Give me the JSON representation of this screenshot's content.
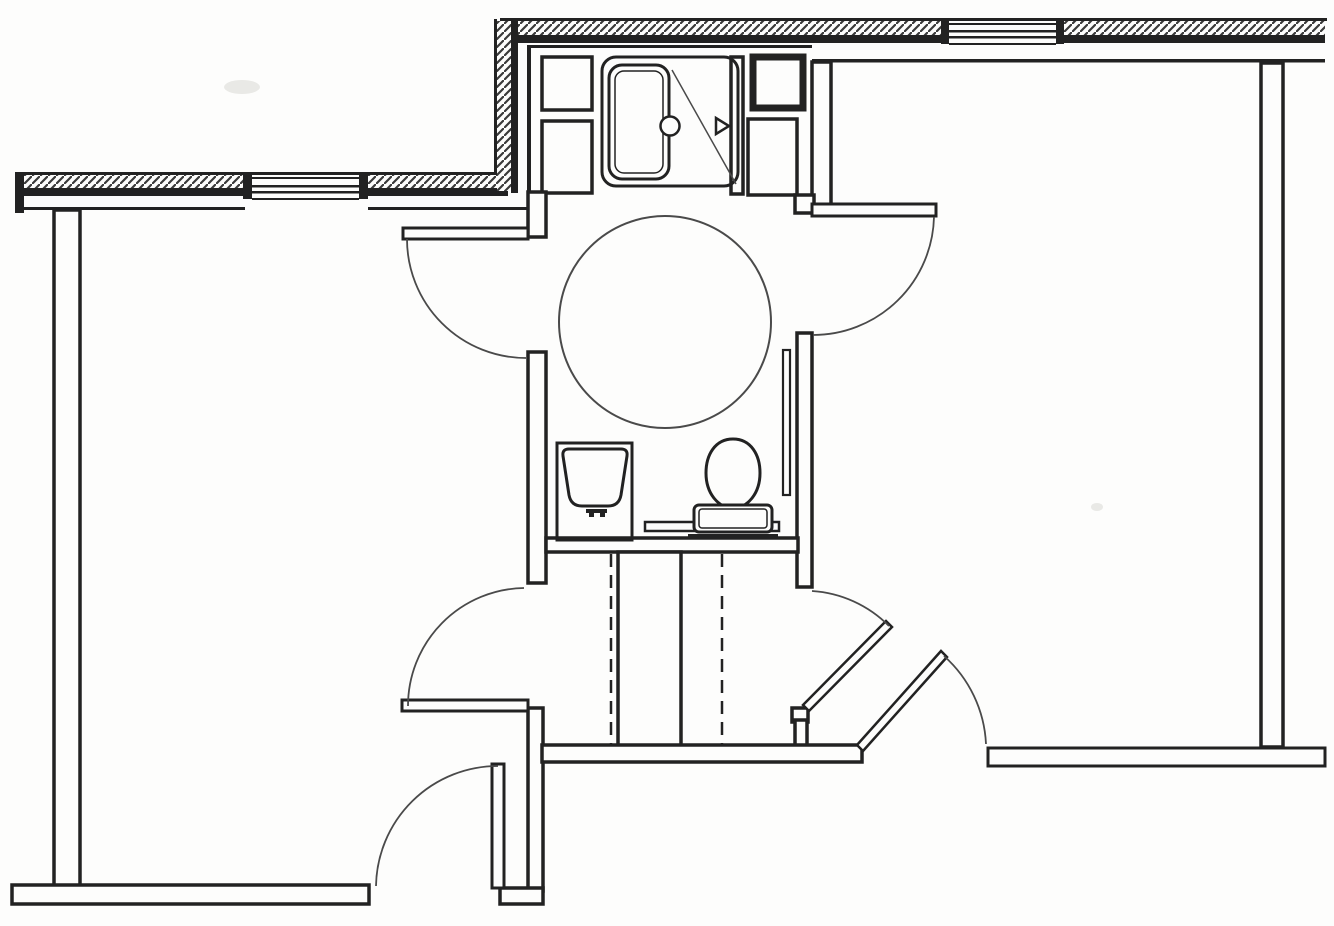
{
  "meta": {
    "description": "accessible-bathroom-floor-plan",
    "canvas": {
      "width": 1334,
      "height": 926
    }
  },
  "palette": {
    "paper": "#fdfdfc",
    "ink": "#222222",
    "light": "#4a4a4a",
    "hatch": "#3a3a3a",
    "smudge": "#e9e9e6"
  },
  "plan": {
    "elements": [
      {
        "name": "scan-smudge-1",
        "kind": "blob",
        "cx": 242,
        "cy": 87,
        "rx": 18,
        "ry": 7
      },
      {
        "name": "scan-smudge-2",
        "kind": "blob",
        "cx": 1097,
        "cy": 507,
        "rx": 6,
        "ry": 4
      },
      {
        "name": "north-wall-outer-edge",
        "kind": "fillrect",
        "x": 500,
        "y": 18,
        "w": 827,
        "h": 3
      },
      {
        "name": "north-wall-hatch-west",
        "kind": "hatchrect",
        "x": 504,
        "y": 21,
        "w": 439,
        "h": 15
      },
      {
        "name": "north-wall-inner-band-west",
        "kind": "fillrect",
        "x": 504,
        "y": 35,
        "w": 439,
        "h": 8
      },
      {
        "name": "north-wall-hatch-east",
        "kind": "hatchrect",
        "x": 1063,
        "y": 21,
        "w": 262,
        "h": 15
      },
      {
        "name": "north-wall-inner-band-east",
        "kind": "fillrect",
        "x": 1063,
        "y": 35,
        "w": 262,
        "h": 8
      },
      {
        "name": "shower-room-ceiling-face-line",
        "kind": "fillrect",
        "x": 527,
        "y": 45,
        "w": 285,
        "h": 3
      },
      {
        "name": "east-room-ceiling-face-line",
        "kind": "fillrect",
        "x": 812,
        "y": 59,
        "w": 513,
        "h": 3.5
      },
      {
        "name": "north-window-jamb-west",
        "kind": "fillrect",
        "x": 941,
        "y": 20,
        "w": 8,
        "h": 24
      },
      {
        "name": "north-window-jamb-east",
        "kind": "fillrect",
        "x": 1056,
        "y": 20,
        "w": 8,
        "h": 24
      },
      {
        "name": "north-window-line-1",
        "kind": "fillrect",
        "x": 949,
        "y": 23,
        "w": 107,
        "h": 2
      },
      {
        "name": "north-window-line-2",
        "kind": "fillrect",
        "x": 949,
        "y": 30,
        "w": 107,
        "h": 2.5
      },
      {
        "name": "north-window-line-3",
        "kind": "fillrect",
        "x": 949,
        "y": 36,
        "w": 107,
        "h": 2.5
      },
      {
        "name": "north-window-line-4",
        "kind": "fillrect",
        "x": 949,
        "y": 43,
        "w": 107,
        "h": 2
      },
      {
        "name": "west-wall-outer-edge",
        "kind": "fillrect",
        "x": 16,
        "y": 172,
        "w": 484,
        "h": 3
      },
      {
        "name": "west-wall-hatch-a",
        "kind": "hatchrect",
        "x": 17,
        "y": 175,
        "w": 228,
        "h": 13
      },
      {
        "name": "west-wall-band-a",
        "kind": "fillrect",
        "x": 17,
        "y": 188,
        "w": 228,
        "h": 8
      },
      {
        "name": "west-wall-hatch-b",
        "kind": "hatchrect",
        "x": 368,
        "y": 175,
        "w": 145,
        "h": 13
      },
      {
        "name": "west-wall-band-b",
        "kind": "fillrect",
        "x": 368,
        "y": 188,
        "w": 140,
        "h": 8
      },
      {
        "name": "west-wall-end-cap",
        "kind": "fillrect",
        "x": 15,
        "y": 172,
        "w": 9,
        "h": 41
      },
      {
        "name": "west-room-ceiling-face-line-a",
        "kind": "fillrect",
        "x": 24,
        "y": 207,
        "w": 221,
        "h": 3
      },
      {
        "name": "west-room-ceiling-face-line-b",
        "kind": "fillrect",
        "x": 368,
        "y": 207,
        "w": 162,
        "h": 3
      },
      {
        "name": "west-window-jamb-left",
        "kind": "fillrect",
        "x": 243,
        "y": 173,
        "w": 9,
        "h": 26
      },
      {
        "name": "west-window-jamb-right",
        "kind": "fillrect",
        "x": 359,
        "y": 173,
        "w": 9,
        "h": 26
      },
      {
        "name": "west-window-line-1",
        "kind": "fillrect",
        "x": 252,
        "y": 177,
        "w": 107,
        "h": 2
      },
      {
        "name": "west-window-line-2",
        "kind": "fillrect",
        "x": 252,
        "y": 185,
        "w": 107,
        "h": 2.5
      },
      {
        "name": "west-window-line-3",
        "kind": "fillrect",
        "x": 252,
        "y": 191,
        "w": 107,
        "h": 2.5
      },
      {
        "name": "west-window-line-4",
        "kind": "fillrect",
        "x": 252,
        "y": 198,
        "w": 107,
        "h": 2
      },
      {
        "name": "wall-jog-outer-edge",
        "kind": "fillrect",
        "x": 494,
        "y": 19,
        "w": 3,
        "h": 155
      },
      {
        "name": "wall-jog-hatch",
        "kind": "hatchrect",
        "x": 497,
        "y": 21,
        "w": 15,
        "h": 170
      },
      {
        "name": "wall-jog-inner-band",
        "kind": "fillrect",
        "x": 511,
        "y": 21,
        "w": 7,
        "h": 172
      },
      {
        "name": "shower-room-west-face-line",
        "kind": "fillrect",
        "x": 527,
        "y": 45,
        "w": 4,
        "h": 148
      },
      {
        "name": "closet-box-west",
        "kind": "wallrect",
        "x": 542,
        "y": 57,
        "w": 50,
        "h": 53
      },
      {
        "name": "chase-box-west",
        "kind": "wallrect",
        "x": 542,
        "y": 121,
        "w": 50,
        "h": 72
      },
      {
        "name": "shower-partition-east",
        "kind": "wallrect",
        "x": 731,
        "y": 57,
        "w": 12,
        "h": 137
      },
      {
        "name": "duct-box-east-bold",
        "kind": "wallrect",
        "x": 753,
        "y": 57,
        "w": 50,
        "h": 51,
        "sw": 7
      },
      {
        "name": "chase-box-east",
        "kind": "wallrect",
        "x": 748,
        "y": 119,
        "w": 49,
        "h": 76
      },
      {
        "name": "east-room-wall-upper",
        "kind": "wallrect",
        "x": 812,
        "y": 62,
        "w": 19,
        "h": 151
      },
      {
        "name": "bath-west-wall-upper-jamb",
        "kind": "wallrect",
        "x": 528,
        "y": 192,
        "w": 18,
        "h": 45
      },
      {
        "name": "bath-west-wall-mid",
        "kind": "wallrect",
        "x": 528,
        "y": 352,
        "w": 18,
        "h": 231
      },
      {
        "name": "bath-west-wall-lower",
        "kind": "wallrect",
        "x": 528,
        "y": 708,
        "w": 15,
        "h": 183
      },
      {
        "name": "hall-southwest-corner-wall",
        "kind": "wallrect",
        "x": 500,
        "y": 888,
        "w": 43,
        "h": 16
      },
      {
        "name": "bath-east-jamb-upper",
        "kind": "wallrect",
        "x": 795,
        "y": 195,
        "w": 19,
        "h": 18
      },
      {
        "name": "bath-east-wall-mid",
        "kind": "wallrect",
        "x": 797,
        "y": 333,
        "w": 15,
        "h": 254
      },
      {
        "name": "bath-east-jamb-lower",
        "kind": "wallrect",
        "x": 792,
        "y": 708,
        "w": 16,
        "h": 14
      },
      {
        "name": "bath-east-wall-stub",
        "kind": "wallrect",
        "x": 795,
        "y": 720,
        "w": 12,
        "h": 27
      },
      {
        "name": "bath-south-wall",
        "kind": "wallrect",
        "x": 546,
        "y": 538,
        "w": 252,
        "h": 14
      },
      {
        "name": "hall-chase-wall",
        "kind": "wallrect",
        "x": 618,
        "y": 552,
        "w": 63,
        "h": 194
      },
      {
        "name": "hall-south-wall-west",
        "kind": "wallrect",
        "x": 542,
        "y": 745,
        "w": 320,
        "h": 17
      },
      {
        "name": "south-wall-east",
        "kind": "wallrect",
        "x": 988,
        "y": 748,
        "w": 337,
        "h": 18,
        "sw": 3
      },
      {
        "name": "east-room-east-wall",
        "kind": "wallrect",
        "x": 1261,
        "y": 63,
        "w": 22,
        "h": 684
      },
      {
        "name": "west-room-west-wall",
        "kind": "wallrect",
        "x": 54,
        "y": 210,
        "w": 26,
        "h": 679
      },
      {
        "name": "west-room-south-wall",
        "kind": "wallrect",
        "x": 12,
        "y": 885,
        "w": 357,
        "h": 19
      },
      {
        "name": "hall-header-dashed-line-west",
        "kind": "dashedvline",
        "x": 611,
        "y1": 554,
        "y2": 744
      },
      {
        "name": "hall-header-dashed-line-east",
        "kind": "dashedvline",
        "x": 722,
        "y1": 554,
        "y2": 744
      },
      {
        "name": "turning-circle",
        "kind": "circle",
        "cx": 665,
        "cy": 322,
        "r": 106,
        "sw": 2,
        "stroke": "light"
      },
      {
        "name": "shower-enclosure",
        "kind": "rrect",
        "x": 602,
        "y": 57,
        "w": 136,
        "h": 129,
        "r": 14,
        "sw": 3
      },
      {
        "name": "shower-door-diagonal",
        "kind": "line",
        "x1": 672,
        "y1": 70,
        "x2": 736,
        "y2": 184,
        "sw": 1.5,
        "stroke": "light"
      },
      {
        "name": "shower-pan",
        "kind": "rrect",
        "x": 609,
        "y": 65,
        "w": 60,
        "h": 114,
        "r": 13,
        "sw": 3,
        "fill": "paper"
      },
      {
        "name": "shower-pan-inner",
        "kind": "rrect",
        "x": 615,
        "y": 71,
        "w": 48,
        "h": 102,
        "r": 9,
        "sw": 1.5
      },
      {
        "name": "shower-drain",
        "kind": "circle",
        "cx": 670,
        "cy": 126,
        "r": 9.5,
        "sw": 2.5,
        "fill": "paper"
      },
      {
        "name": "shower-head-symbol",
        "kind": "polygon",
        "points": "716,118 716,134 729,126",
        "sw": 2.5,
        "fill": "paper"
      },
      {
        "name": "grab-bar-horizontal",
        "kind": "wallrect",
        "x": 645,
        "y": 522,
        "w": 134,
        "h": 9,
        "sw": 2.5
      },
      {
        "name": "grab-bar-vertical",
        "kind": "wallrect",
        "x": 783,
        "y": 350,
        "w": 7,
        "h": 145,
        "sw": 2.2
      },
      {
        "name": "sink-counter",
        "kind": "rect",
        "x": 557,
        "y": 443,
        "w": 75,
        "h": 97,
        "sw": 3
      },
      {
        "name": "sink-bowl",
        "kind": "path",
        "d": "M 569,449 L 621,449 Q 628,449 627,456 L 621,495 Q 619,506 608,506 L 582,506 Q 571,506 569,495 L 563,456 Q 562,449 569,449 Z",
        "sw": 3
      },
      {
        "name": "sink-faucet",
        "kind": "fillrect",
        "x": 586,
        "y": 509,
        "w": 21,
        "h": 4
      },
      {
        "name": "sink-faucet-handle-left",
        "kind": "fillrect",
        "x": 589,
        "y": 513,
        "w": 5,
        "h": 4
      },
      {
        "name": "sink-faucet-handle-right",
        "kind": "fillrect",
        "x": 600,
        "y": 513,
        "w": 5,
        "h": 4
      },
      {
        "name": "toilet-bowl",
        "kind": "path",
        "d": "M 733,439 C 715,439 706,455 706,473 C 706,493 718,508 733,508 C 748,508 760,493 760,473 C 760,455 751,439 733,439 Z",
        "sw": 3,
        "fill": "paper"
      },
      {
        "name": "toilet-tank",
        "kind": "wallrect",
        "x": 694,
        "y": 505,
        "w": 78,
        "h": 27,
        "r": 5,
        "sw": 3
      },
      {
        "name": "toilet-tank-inner",
        "kind": "rrect",
        "x": 699,
        "y": 509,
        "w": 68,
        "h": 19,
        "r": 3,
        "sw": 1.5
      },
      {
        "name": "toilet-base-line",
        "kind": "fillrect",
        "x": 688,
        "y": 534,
        "w": 90,
        "h": 3
      },
      {
        "name": "door-leaf-west-room-north",
        "kind": "wallrect",
        "x": 403,
        "y": 228,
        "w": 125,
        "h": 11,
        "sw": 3
      },
      {
        "name": "door-swing-west-room-north",
        "kind": "path",
        "d": "M 407,239 A 119,119 0 0 0 526,358",
        "sw": 1.8,
        "stroke": "light"
      },
      {
        "name": "door-leaf-east-room-north",
        "kind": "wallrect",
        "x": 812,
        "y": 204,
        "w": 124,
        "h": 12,
        "sw": 3
      },
      {
        "name": "door-swing-east-room-north",
        "kind": "path",
        "d": "M 934,217 A 121,121 0 0 1 813,335",
        "sw": 1.8,
        "stroke": "light"
      },
      {
        "name": "door-leaf-hall-west",
        "kind": "wallrect",
        "x": 402,
        "y": 700,
        "w": 126,
        "h": 11,
        "sw": 3
      },
      {
        "name": "door-swing-hall-west",
        "kind": "path",
        "d": "M 524,588 A 118,118 0 0 0 408,706",
        "sw": 1.8,
        "stroke": "light"
      },
      {
        "name": "door-leaf-hall-east-diagonal",
        "kind": "polygon",
        "points": "803,705 886,621 892,627 809,711",
        "sw": 2.5,
        "fill": "paper"
      },
      {
        "name": "door-swing-hall-east",
        "kind": "path",
        "d": "M 812,591 A 119,119 0 0 1 889,626",
        "sw": 1.8,
        "stroke": "light"
      },
      {
        "name": "door-leaf-east-room-entry-diagonal",
        "kind": "polygon",
        "points": "857,745 941,651 947,657 863,751",
        "sw": 2.5,
        "fill": "paper"
      },
      {
        "name": "door-swing-east-room-entry",
        "kind": "path",
        "d": "M 944,656 A 126,126 0 0 1 986,744",
        "sw": 1.8,
        "stroke": "light"
      },
      {
        "name": "door-leaf-west-room-entry",
        "kind": "wallrect",
        "x": 492,
        "y": 764,
        "w": 12,
        "h": 124,
        "sw": 3
      },
      {
        "name": "door-swing-west-room-entry",
        "kind": "path",
        "d": "M 498,766 A 122,122 0 0 0 376,886",
        "sw": 1.8,
        "stroke": "light"
      }
    ]
  }
}
